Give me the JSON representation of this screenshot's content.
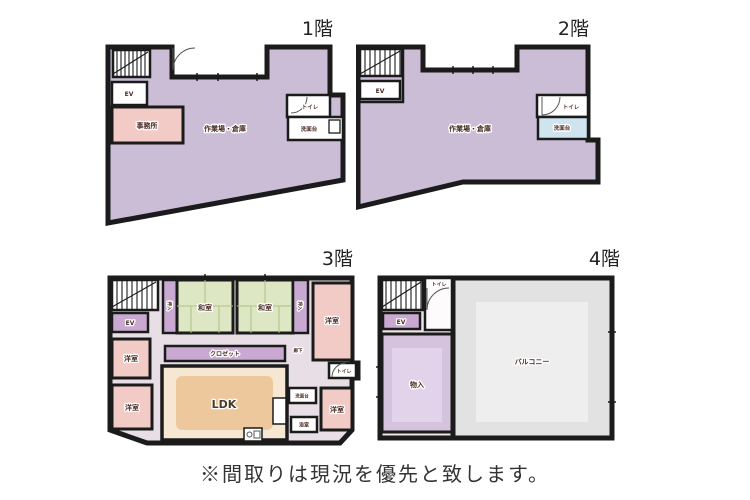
{
  "caption": "※間取りは現況を優先と致します。",
  "floors": {
    "f1": {
      "title": "1階",
      "ev": "EV",
      "office": "事務所",
      "main": "作業場・倉庫",
      "toilet": "トイレ",
      "wash": "洗面台"
    },
    "f2": {
      "title": "2階",
      "ev": "EV",
      "main": "作業場・倉庫",
      "toilet": "トイレ",
      "wash": "洗面台"
    },
    "f3": {
      "title": "3階",
      "ev": "EV",
      "washitsu_a": "和室",
      "washitsu_b": "和室",
      "oshiire_a": "押入",
      "oshiire_b": "押入",
      "closet": "クロゼット",
      "ldk": "LDK",
      "hall": "廊下",
      "youshitsu_tr": "洋室",
      "youshitsu_l1": "洋室",
      "youshitsu_l2": "洋室",
      "youshitsu_br": "洋室",
      "toilet": "トイレ",
      "wash": "洗面台",
      "bath": "浴室"
    },
    "f4": {
      "title": "4階",
      "ev": "EV",
      "toilet": "トイレ",
      "storage": "物入",
      "balcony": "バルコニー"
    }
  },
  "colors": {
    "wall": "#1b1b1b",
    "main_area": "#cbbdd6",
    "room_pink": "#f3cbc6",
    "tatami_green": "#dde7c3",
    "closet_purple": "#c9a9d2",
    "ldk_orange": "#edc89d",
    "ldk_light": "#f6e7d3",
    "storage_purple": "#d5c3de",
    "storage_light": "#e3d3ea",
    "balcony_gray": "#e2e2e2",
    "balcony_light": "#eeeeee",
    "washbasin_blue": "#cfe4ef",
    "corridor": "#e7dfe5",
    "corridor_pink": "#ece4e6"
  }
}
